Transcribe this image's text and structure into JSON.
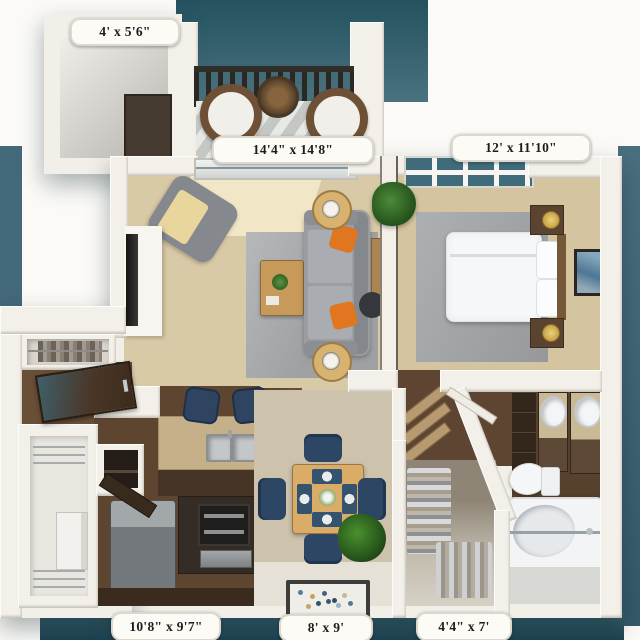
{
  "image": {
    "type": "3d-floor-plan",
    "view": "top-down",
    "unit": "one-bedroom apartment with balcony"
  },
  "room_labels": {
    "storage": "4' x 5'6\"",
    "living_room": "14'4\" x 14'8\"",
    "bedroom": "12' x 11'10\"",
    "kitchen": "10'8\" x 9'7\"",
    "dining": "8' x 9'",
    "closet": "4'4\" x 7'"
  },
  "colors": {
    "backdrop_teal": "#44697b",
    "backdrop_teal_dark": "#24525f",
    "wall_white": "#f3f0e9",
    "carpet_tan": "#d9caa7",
    "rug_gray": "#a6a8aa",
    "wood_floor_brown": "#5e4530",
    "entry_tile": "#e6e1d6",
    "counter_granite_tan": "#c6b08a",
    "cabinet_brown": "#463426",
    "sofa_gray": "#999ca1",
    "pillow_orange": "#e0761f",
    "chair_navy": "#2d4663",
    "table_wood": "#d9ad67",
    "fixture_white": "#f5f6f7",
    "glass_teal": "#3f6b7a"
  }
}
